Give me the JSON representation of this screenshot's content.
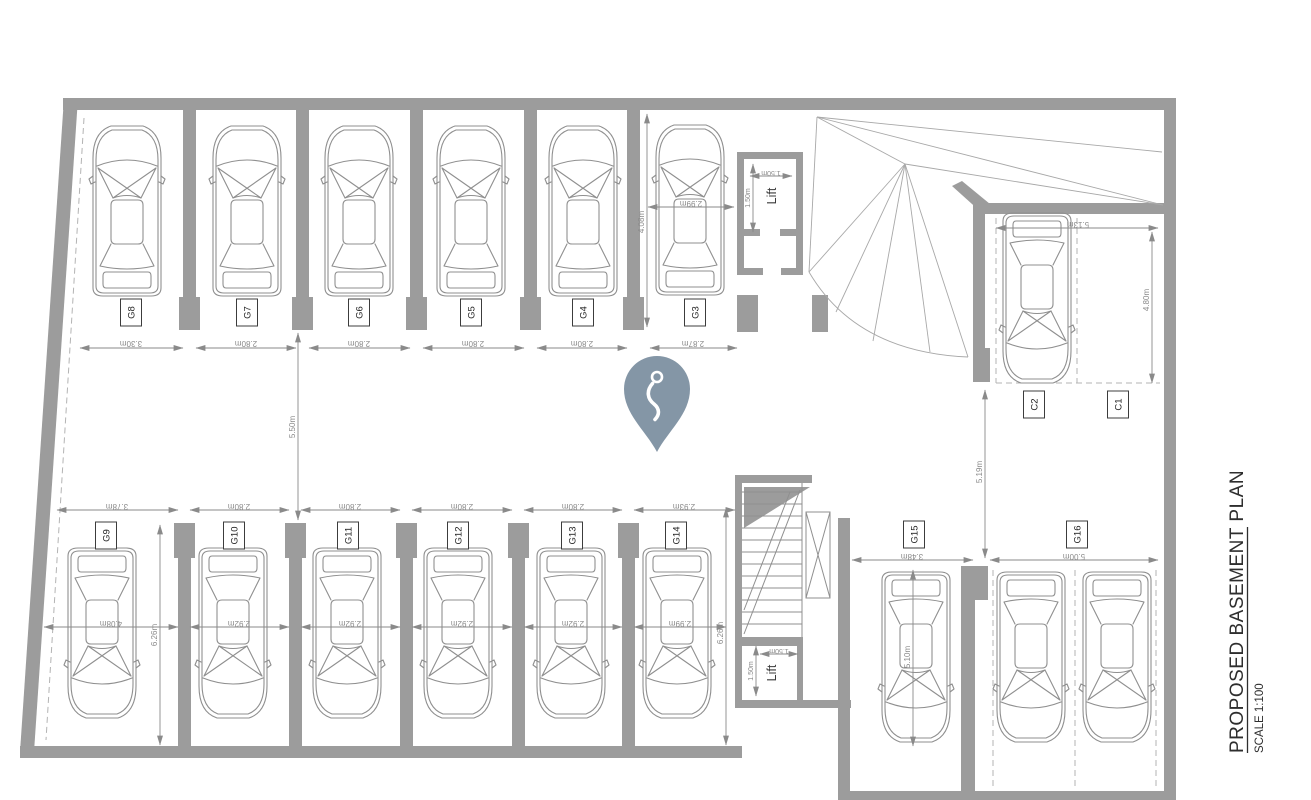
{
  "title": {
    "main": "PROPOSED BASEMENT PLAN",
    "scale": "SCALE 1:100"
  },
  "colors": {
    "wall": "#9c9c9c",
    "line": "#8f8f8f",
    "dim": "#8a8a8a",
    "dash": "#b3b3b3",
    "fan": "#a8a8a8",
    "pin": "#8496a6",
    "label": "#222222",
    "title": "#2e2e2e",
    "bg": "#ffffff"
  },
  "stalls": {
    "top": [
      {
        "id": "G8"
      },
      {
        "id": "G7"
      },
      {
        "id": "G6"
      },
      {
        "id": "G5"
      },
      {
        "id": "G4"
      },
      {
        "id": "G3"
      }
    ],
    "bottom": [
      {
        "id": "G9"
      },
      {
        "id": "G10"
      },
      {
        "id": "G11"
      },
      {
        "id": "G12"
      },
      {
        "id": "G13"
      },
      {
        "id": "G14"
      }
    ],
    "right": [
      {
        "id": "C2"
      },
      {
        "id": "C1"
      },
      {
        "id": "G15"
      },
      {
        "id": "G16"
      }
    ]
  },
  "lifts": {
    "top": "Lift",
    "bottom": "Lift"
  },
  "dims": {
    "top_widths": [
      "3.30m",
      "2.80m",
      "2.80m",
      "2.80m",
      "2.80m",
      "2.87m"
    ],
    "bottom_widths": [
      "3.78m",
      "2.80m",
      "2.80m",
      "2.80m",
      "2.80m",
      "2.93m"
    ],
    "bottom_car_widths": [
      "4.08m",
      "2.92m",
      "2.92m",
      "2.92m",
      "2.92m",
      "2.99m"
    ],
    "aisle_width": "5.50m",
    "g9_depth": "6.26m",
    "g14_depth": "6.26m",
    "g3_depth": "4.08m",
    "g3_car_width": "2.99m",
    "c_bay_width": "5.13m",
    "c_bay_depth": "4.80m",
    "right_aisle": "5.19m",
    "g15_width": "3.48m",
    "g15_depth": "5.10m",
    "g16_width": "5.00m",
    "lift_top_width": "1.50m",
    "lift_top_depth": "1.50m",
    "lift_bottom_width": "1.50m",
    "lift_bottom_depth": "1.50m"
  }
}
